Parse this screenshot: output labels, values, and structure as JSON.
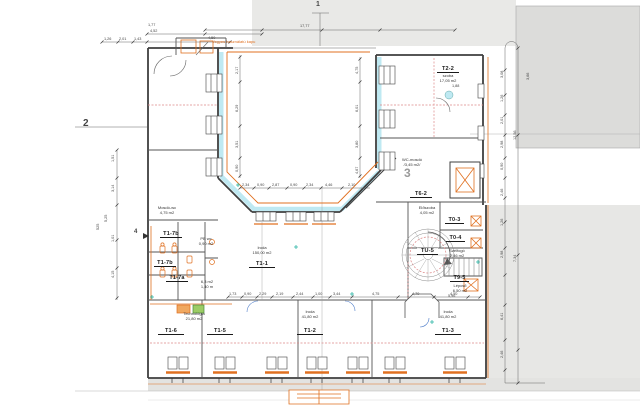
{
  "drawing": {
    "type": "architectural-floor-plan",
    "axis": {
      "a1": "1",
      "a2": "2",
      "a3": "3",
      "a4": "4"
    },
    "note": {
      "gate": "Vegyes használatú kapu"
    },
    "rooms": [
      {
        "id": "T2-2",
        "name": "szoba",
        "area": "17,05 m2"
      },
      {
        "id": "T6-2"
      },
      {
        "id": "T0-3"
      },
      {
        "id": "T0-4"
      },
      {
        "id": "TU-5"
      },
      {
        "id": "T9-5",
        "name": "Lépcső",
        "area": "6,50 m2"
      },
      {
        "id": "T1-1",
        "name": "Iroda",
        "area": "150,00 m2"
      },
      {
        "id": "T1-2",
        "name": "Iroda",
        "area": "41,80 m2"
      },
      {
        "id": "T1-3",
        "name": "Iroda",
        "area": "41,80 m2"
      },
      {
        "id": "T1-5"
      },
      {
        "id": "T1-6"
      },
      {
        "id": "T1-7b"
      },
      {
        "id": "T1-7b"
      },
      {
        "id": "T1-7a"
      }
    ],
    "annotations": [
      {
        "l1": "Mosdó-wc",
        "l2": "4,75 m2"
      },
      {
        "l1": "PB wc",
        "l2": "0,90 m2"
      },
      {
        "l1": "6,3 m2",
        "l2": "1,40 m"
      },
      {
        "l1": "Technológia",
        "l2": "21,80 m2"
      },
      {
        "l1": "WC-mosdó",
        "l2": "/3,45 m2/"
      },
      {
        "l1": "Előszoba",
        "l2": "4,05 m2"
      },
      {
        "l1": "Szélfogó",
        "l2": "2,46 m2"
      }
    ],
    "colors": {
      "wall": "#3f3f3f",
      "new_construction_orange": "#e07020",
      "insulation_cyan": "#bfe9f2",
      "demolition_pink": "#dd8888",
      "highlight_green": "#9ccc65",
      "teal_marker": "#2ab5a5",
      "neighbour_gray": "#e7e7e5"
    },
    "dims": [
      {
        "t": "1,77",
        "x": 148,
        "y": 23
      },
      {
        "t": "4,52",
        "x": 150,
        "y": 29
      },
      {
        "t": "4,50",
        "x": 208,
        "y": 36
      },
      {
        "t": "17,77",
        "x": 300,
        "y": 24
      },
      {
        "t": "1,26",
        "x": 104,
        "y": 37
      },
      {
        "t": "2,01",
        "x": 119,
        "y": 37
      },
      {
        "t": "1,43",
        "x": 134,
        "y": 37
      },
      {
        "t": "1,51",
        "x": 111,
        "y": 162,
        "r": -90
      },
      {
        "t": "3,14",
        "x": 111,
        "y": 192,
        "r": -90
      },
      {
        "t": "5,25",
        "x": 104,
        "y": 222,
        "r": -90
      },
      {
        "t": "1,01",
        "x": 111,
        "y": 242,
        "r": -90
      },
      {
        "t": "4,15",
        "x": 111,
        "y": 278,
        "r": -90
      },
      {
        "t": "525",
        "x": 96,
        "y": 230,
        "r": -90
      },
      {
        "t": "2,17",
        "x": 235,
        "y": 74,
        "r": -90
      },
      {
        "t": "6,29",
        "x": 235,
        "y": 112,
        "r": -90
      },
      {
        "t": "3,51",
        "x": 235,
        "y": 148,
        "r": -90
      },
      {
        "t": "0,90",
        "x": 235,
        "y": 172,
        "r": -90
      },
      {
        "t": "4,75",
        "x": 355,
        "y": 74,
        "r": -90
      },
      {
        "t": "6,01",
        "x": 355,
        "y": 112,
        "r": -90
      },
      {
        "t": "3,80",
        "x": 355,
        "y": 148,
        "r": -90
      },
      {
        "t": "4,67",
        "x": 355,
        "y": 174,
        "r": -90
      },
      {
        "t": "2,34",
        "x": 242,
        "y": 183
      },
      {
        "t": "0,90",
        "x": 257,
        "y": 183
      },
      {
        "t": "2,87",
        "x": 272,
        "y": 183
      },
      {
        "t": "0,90",
        "x": 290,
        "y": 183
      },
      {
        "t": "2,34",
        "x": 306,
        "y": 183
      },
      {
        "t": "4,46",
        "x": 325,
        "y": 183
      },
      {
        "t": "2,10",
        "x": 348,
        "y": 183
      },
      {
        "t": "1,73",
        "x": 229,
        "y": 292
      },
      {
        "t": "0,90",
        "x": 244,
        "y": 292
      },
      {
        "t": "2,29",
        "x": 259,
        "y": 292
      },
      {
        "t": "2,19",
        "x": 276,
        "y": 292
      },
      {
        "t": "2,44",
        "x": 296,
        "y": 292
      },
      {
        "t": "1,00",
        "x": 315,
        "y": 292
      },
      {
        "t": "3,44",
        "x": 333,
        "y": 292
      },
      {
        "t": "4,75",
        "x": 372,
        "y": 292
      },
      {
        "t": "4,70",
        "x": 412,
        "y": 292
      },
      {
        "t": "4,50",
        "x": 450,
        "y": 292
      },
      {
        "t": "3,08",
        "x": 500,
        "y": 78,
        "r": -90
      },
      {
        "t": "1,26",
        "x": 500,
        "y": 102,
        "r": -90
      },
      {
        "t": "2,01",
        "x": 500,
        "y": 124,
        "r": -90
      },
      {
        "t": "2,98",
        "x": 500,
        "y": 148,
        "r": -90
      },
      {
        "t": "0,90",
        "x": 500,
        "y": 170,
        "r": -90
      },
      {
        "t": "2,46",
        "x": 500,
        "y": 196,
        "r": -90
      },
      {
        "t": "1,26",
        "x": 500,
        "y": 226,
        "r": -90
      },
      {
        "t": "2,98",
        "x": 500,
        "y": 258,
        "r": -90
      },
      {
        "t": "6,41",
        "x": 500,
        "y": 320,
        "r": -90
      },
      {
        "t": "2,46",
        "x": 500,
        "y": 358,
        "r": -90
      },
      {
        "t": "12,56",
        "x": 513,
        "y": 140,
        "r": -90
      },
      {
        "t": "7,34",
        "x": 513,
        "y": 262,
        "r": -90
      },
      {
        "t": "3,66",
        "x": 526,
        "y": 80,
        "r": -90
      },
      {
        "t": "1,88",
        "x": 452,
        "y": 84
      },
      {
        "t": "5,96",
        "x": 448,
        "y": 294
      }
    ]
  }
}
